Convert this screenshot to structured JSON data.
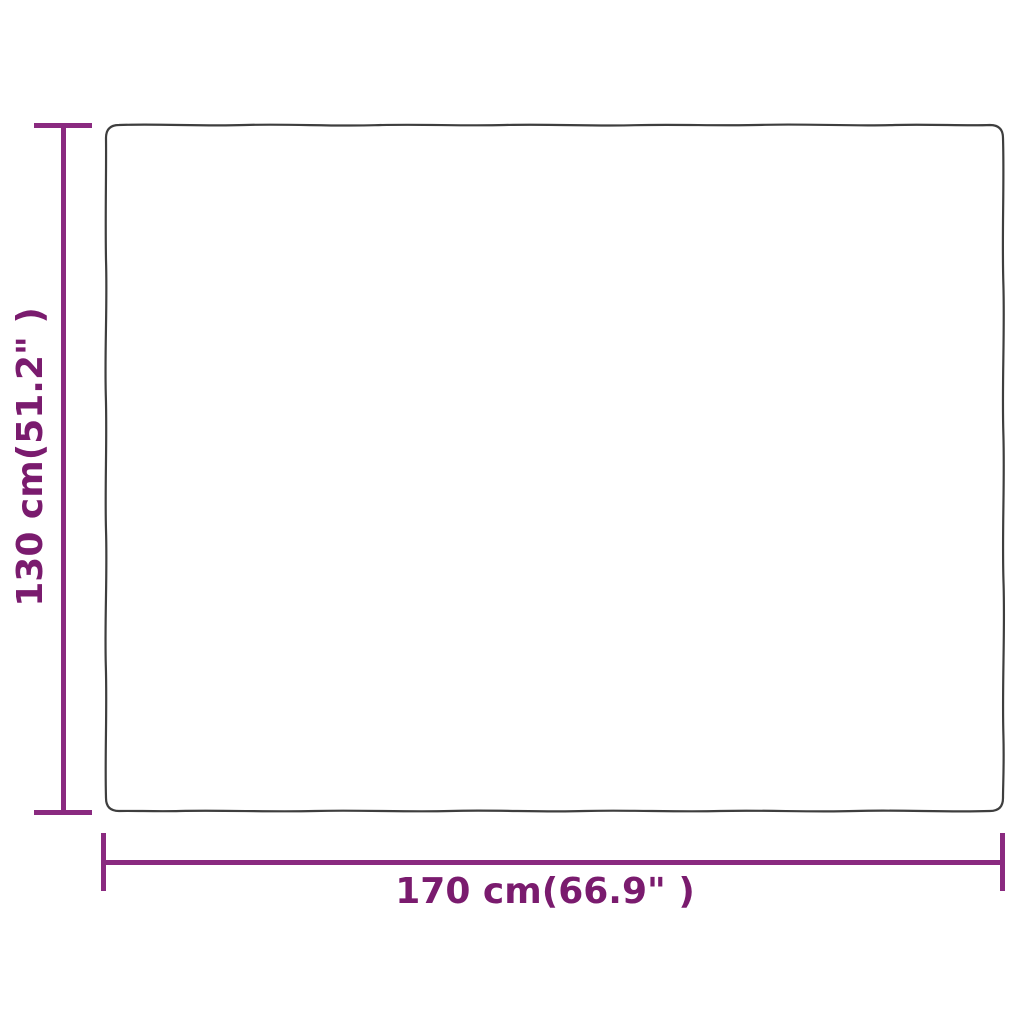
{
  "figure": {
    "type": "product-dimension-diagram",
    "product_shape": "blanket-outline",
    "height_dimension": {
      "label": "130 cm(51.2\" )"
    },
    "width_dimension": {
      "label": "170 cm(66.9\" )"
    },
    "colors": {
      "background": "#ffffff",
      "outline": "#3e3e3e",
      "dimension_line": "#8a2a80",
      "label_text": "#7a1b6e"
    }
  }
}
